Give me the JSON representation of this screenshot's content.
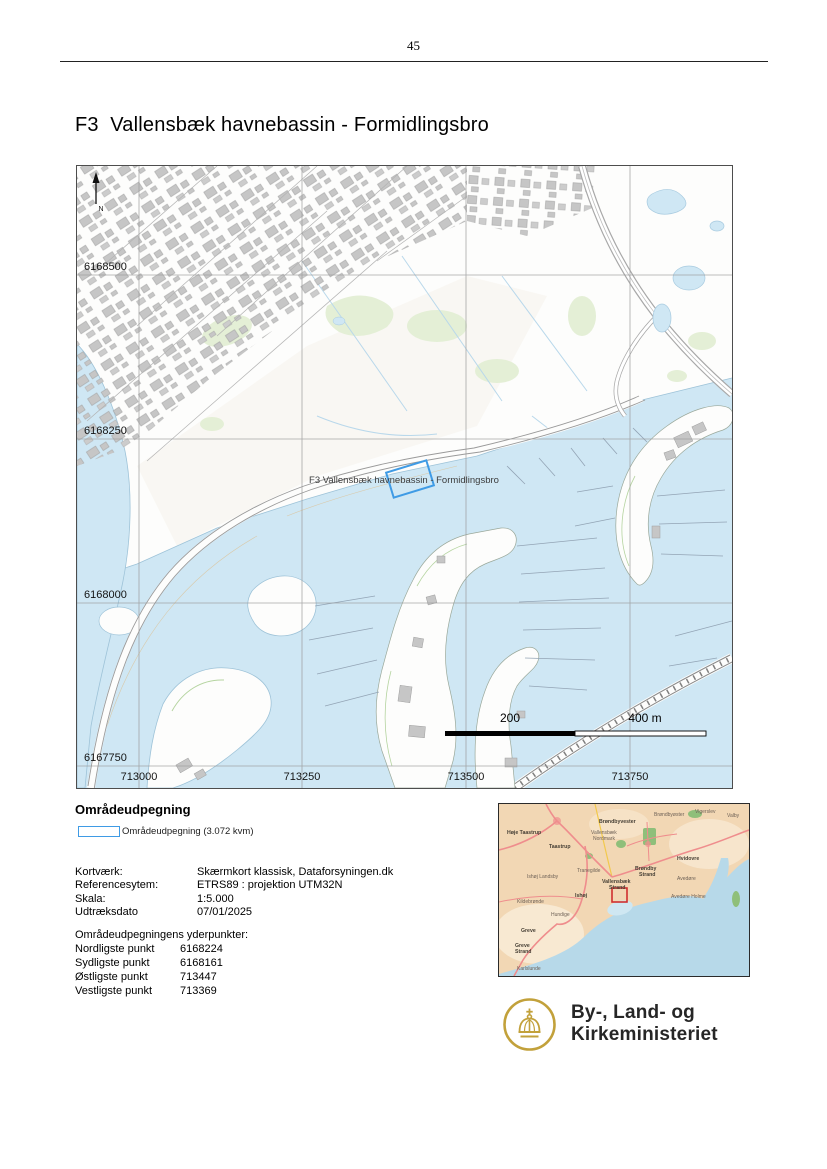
{
  "page": {
    "number": "45",
    "title": "F3  Vallensbæk havnebassin - Formidlingsbro"
  },
  "map": {
    "feature_label": "F3 Vallensbæk havnebassin - Formidlingsbro",
    "north_label": "N",
    "y_ticks": [
      "6168500",
      "6168250",
      "6168000",
      "6167750"
    ],
    "x_ticks": [
      "713000",
      "713250",
      "713500",
      "713750"
    ],
    "scale_mid": "200",
    "scale_end": "400 m",
    "colors": {
      "water": "#cfe7f4",
      "area_outline": "#3f9be5",
      "grid": "#9a9a9a"
    }
  },
  "legend": {
    "heading": "Områdeudpegning",
    "item": "Områdeudpegning (3.072 kvm)"
  },
  "details": {
    "rows": [
      {
        "label": "Kortværk:",
        "value": "Skærmkort klassisk, Dataforsyningen.dk"
      },
      {
        "label": "Referencesytem:",
        "value": "ETRS89 : projektion UTM32N"
      },
      {
        "label": "Skala:",
        "value": "1:5.000"
      },
      {
        "label": "Udtræksdato",
        "value": "07/01/2025"
      }
    ]
  },
  "extremes": {
    "heading": "Områdeudpegningens yderpunkter:",
    "rows": [
      {
        "label": "Nordligste punkt",
        "value": "6168224"
      },
      {
        "label": "Sydligste punkt",
        "value": "6168161"
      },
      {
        "label": "Østligste punkt",
        "value": "713447"
      },
      {
        "label": "Vestligste punkt",
        "value": "713369"
      }
    ]
  },
  "overview": {
    "marker_color": "#d03030",
    "labels": [
      {
        "t": "Høje Taastrup",
        "x": 8,
        "y": 30,
        "b": true
      },
      {
        "t": "Taastrup",
        "x": 50,
        "y": 44,
        "b": true
      },
      {
        "t": "Vallensbæk",
        "x": 92,
        "y": 30,
        "b": false
      },
      {
        "t": "Nordmark",
        "x": 94,
        "y": 36,
        "b": false
      },
      {
        "t": "Brøndbyvester",
        "x": 100,
        "y": 19,
        "b": true
      },
      {
        "t": "Brøndbyøster",
        "x": 155,
        "y": 12,
        "b": false
      },
      {
        "t": "Vigerslev",
        "x": 196,
        "y": 9,
        "b": false
      },
      {
        "t": "Valby",
        "x": 228,
        "y": 13,
        "b": false
      },
      {
        "t": "Hvidovre",
        "x": 178,
        "y": 56,
        "b": true
      },
      {
        "t": "Brøndby",
        "x": 136,
        "y": 66,
        "b": true
      },
      {
        "t": "Strand",
        "x": 140,
        "y": 72,
        "b": true
      },
      {
        "t": "Avedøre",
        "x": 178,
        "y": 76,
        "b": false
      },
      {
        "t": "Ishøj Landsby",
        "x": 28,
        "y": 74,
        "b": false
      },
      {
        "t": "Tranegilde",
        "x": 78,
        "y": 68,
        "b": false
      },
      {
        "t": "Vallensbæk",
        "x": 103,
        "y": 79,
        "b": true
      },
      {
        "t": "Strand",
        "x": 110,
        "y": 85,
        "b": true
      },
      {
        "t": "Ishøj",
        "x": 76,
        "y": 93,
        "b": true
      },
      {
        "t": "Avedøre Holme",
        "x": 172,
        "y": 94,
        "b": false
      },
      {
        "t": "Kildebrønde",
        "x": 18,
        "y": 99,
        "b": false
      },
      {
        "t": "Hundige",
        "x": 52,
        "y": 112,
        "b": false
      },
      {
        "t": "Greve",
        "x": 22,
        "y": 128,
        "b": true
      },
      {
        "t": "Greve",
        "x": 16,
        "y": 143,
        "b": true
      },
      {
        "t": "Strand",
        "x": 16,
        "y": 149,
        "b": true
      },
      {
        "t": "Karlslunde",
        "x": 18,
        "y": 166,
        "b": false
      }
    ]
  },
  "logo": {
    "line1": "By-, Land- og",
    "line2": "Kirkeministeriet",
    "gold": "#c2a13b"
  }
}
